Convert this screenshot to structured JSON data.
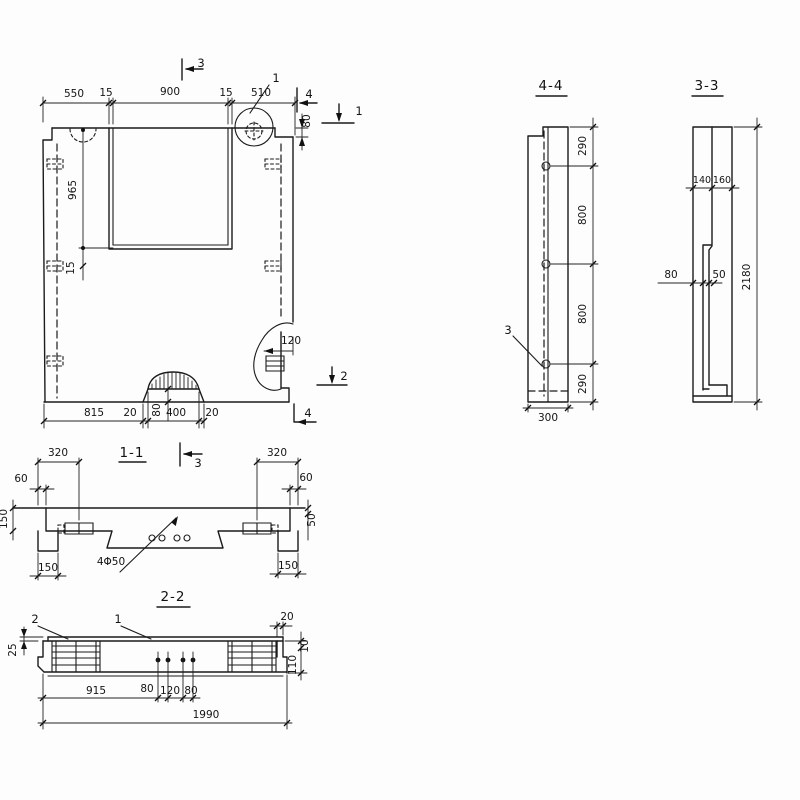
{
  "drawing": {
    "background": "#fdfdfd",
    "ink": "#1b1b1b",
    "main_view": {
      "dim_550": "550",
      "dim_15_left": "15",
      "dim_900": "900",
      "dim_15_right": "15",
      "dim_510": "510",
      "dim_80_step": "80",
      "dim_965": "965",
      "dim_15_sill": "15",
      "dim_120_notch": "120",
      "dim_815": "815",
      "dim_20_left": "20",
      "dim_80_spout": "80",
      "dim_400": "400",
      "dim_20_right": "20",
      "marker_section_3": "3",
      "marker_detail_1": "1",
      "marker_section_4_top": "4",
      "marker_section_1": "1",
      "marker_section_2": "2",
      "marker_section_4_bottom": "4"
    },
    "section_4_4": {
      "title": "4-4",
      "dim_290_top": "290",
      "dim_800_upper": "800",
      "dim_800_lower": "800",
      "dim_290_bottom": "290",
      "dim_300": "300",
      "marker_3": "3"
    },
    "section_3_3": {
      "title": "3-3",
      "dim_140": "140",
      "dim_160": "160",
      "dim_80": "80",
      "dim_50": "50",
      "dim_2180": "2180"
    },
    "section_1_1": {
      "title": "1-1",
      "marker_3": "3",
      "dim_320_left": "320",
      "dim_60_left": "60",
      "dim_320_right": "320",
      "dim_60_right": "60",
      "dim_150_edge": "150",
      "dim_50_right": "50",
      "dim_150_foot_left": "150",
      "dim_150_foot_right": "150",
      "label_holes": "4Φ50"
    },
    "section_2_2": {
      "title": "2-2",
      "marker_2": "2",
      "marker_1": "1",
      "dim_25": "25",
      "dim_20": "20",
      "dim_10": "10",
      "dim_110": "110",
      "dim_915": "915",
      "dim_80_left": "80",
      "dim_120": "120",
      "dim_80_right": "80",
      "dim_1990": "1990"
    }
  }
}
